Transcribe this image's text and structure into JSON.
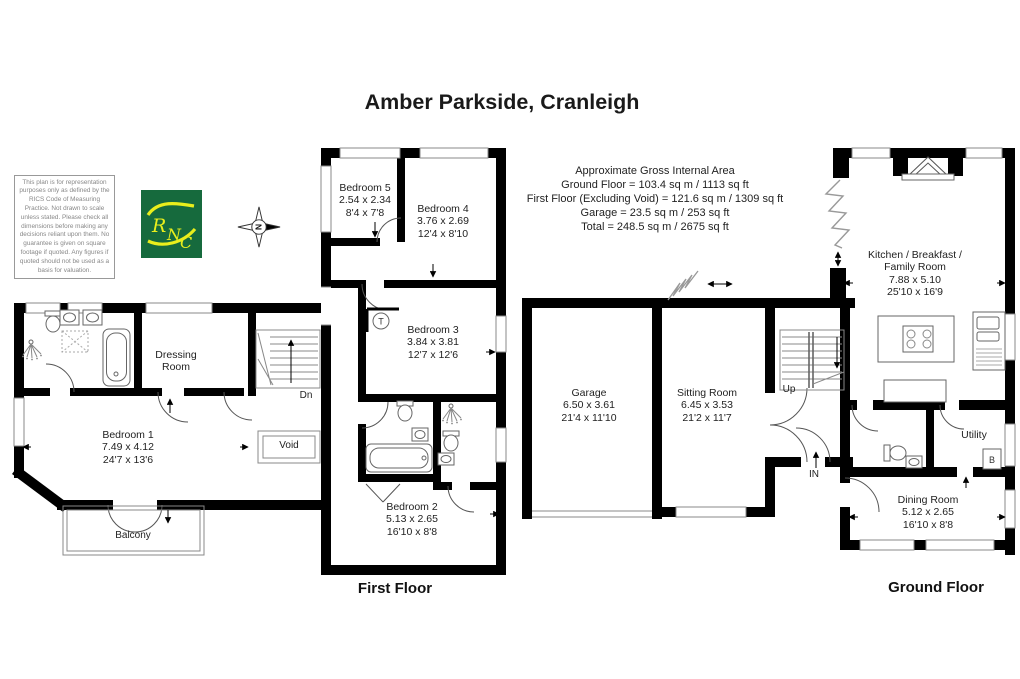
{
  "title": "Amber Parkside, Cranleigh",
  "disclaimer": "This plan is for representation purposes only as defined by the RICS Code of Measuring Practice. Not drawn to scale unless stated. Please check all dimensions before making any decisions reliant upon them. No guarantee is given on square footage if quoted. Any figures if quoted should not be used as a basis for valuation.",
  "logo": {
    "text": "RNC",
    "letters": [
      "R",
      "N",
      "C"
    ],
    "bg_color": "#166a3d",
    "accent_color": "#e9ee1c"
  },
  "compass": {
    "letter": "N"
  },
  "area_summary": {
    "lines": [
      "Approximate Gross Internal Area",
      "Ground Floor = 103.4 sq m / 1113 sq ft",
      "First Floor (Excluding Void) = 121.6 sq m / 1309 sq ft",
      "Garage = 23.5 sq m / 253 sq ft",
      "Total = 248.5 sq m / 2675 sq ft"
    ]
  },
  "first_floor": {
    "label": "First Floor",
    "rooms": {
      "bedroom1": {
        "name": "Bedroom 1",
        "metric": "7.49 x 4.12",
        "imperial": "24'7 x 13'6"
      },
      "bedroom2": {
        "name": "Bedroom 2",
        "metric": "5.13 x 2.65",
        "imperial": "16'10 x 8'8"
      },
      "bedroom3": {
        "name": "Bedroom 3",
        "metric": "3.84 x 3.81",
        "imperial": "12'7 x 12'6"
      },
      "bedroom4": {
        "name": "Bedroom 4",
        "metric": "3.76 x 2.69",
        "imperial": "12'4 x 8'10"
      },
      "bedroom5": {
        "name": "Bedroom 5",
        "metric": "2.54 x 2.34",
        "imperial": "8'4 x 7'8"
      },
      "dressing": {
        "name": "Dressing Room"
      }
    },
    "markers": {
      "stairs": "Dn",
      "void": "Void",
      "balcony": "Balcony",
      "tank": "T"
    }
  },
  "ground_floor": {
    "label": "Ground Floor",
    "rooms": {
      "garage": {
        "name": "Garage",
        "metric": "6.50 x 3.61",
        "imperial": "21'4 x 11'10"
      },
      "sitting": {
        "name": "Sitting Room",
        "metric": "6.45 x 3.53",
        "imperial": "21'2 x 11'7"
      },
      "kitchen": {
        "name": "Kitchen / Breakfast / Family Room",
        "metric": "7.88 x 5.10",
        "imperial": "25'10 x 16'9"
      },
      "dining": {
        "name": "Dining Room",
        "metric": "5.12 x 2.65",
        "imperial": "16'10 x 8'8"
      },
      "utility": {
        "name": "Utility"
      }
    },
    "markers": {
      "stairs": "Up",
      "entrance": "IN",
      "boiler": "B"
    }
  }
}
